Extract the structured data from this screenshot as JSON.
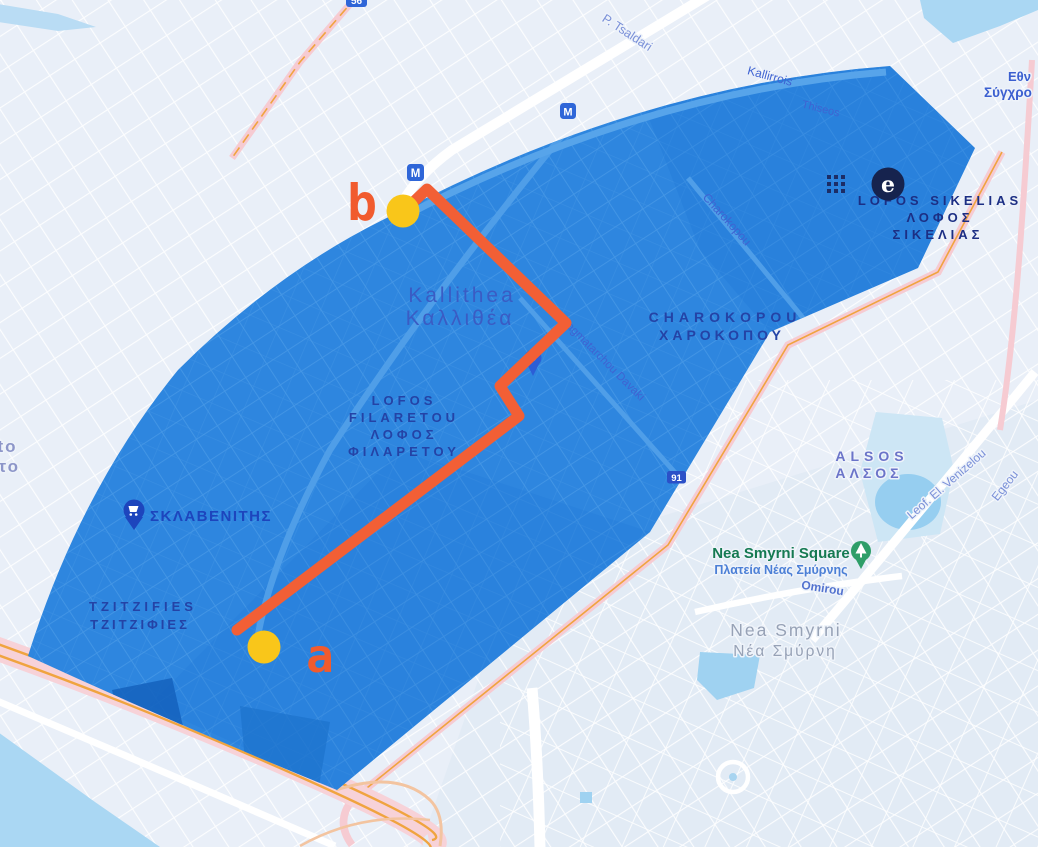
{
  "map": {
    "zone": {
      "description": "blue coverage zone over Kallithea",
      "fill_color": "#2e86df"
    },
    "route": {
      "color": "#f25f35",
      "marker_color": "#f9c61a",
      "marker_letter_color": "#f15b2e",
      "start_label": "a",
      "end_label": "b"
    },
    "region_labels": {
      "kallithea_en": "Kallithea",
      "kallithea_gr": "Καλλιθέα",
      "lofos_filaretou_l1": "LOFOS",
      "lofos_filaretou_l2": "FILARETOU",
      "lofos_filaretou_l3": "ΛΟΦΟΣ",
      "lofos_filaretou_l4": "ΦΙΛΑΡΕΤΟΥ",
      "charokopou_en": "CHAROKOPOU",
      "charokopou_gr": "ΧΑΡΟΚΟΠΟΥ",
      "lofos_sikelias_l1": "LOFOS SIKELIAS",
      "lofos_sikelias_l2": "ΛΟΦΟΣ",
      "lofos_sikelias_l3": "ΣΙΚΕΛΙΑΣ",
      "tzitzifies_en": "TZITZIFIES",
      "tzitzifies_gr": "ΤΖΙΤΖΙΦΙΕΣ",
      "alsos_en": "ALSOS",
      "alsos_gr": "ΑΛΣΟΣ",
      "nea_smyrni_en": "Nea Smyrni",
      "nea_smyrni_gr": "Νέα Σμύρνη",
      "moschato_partial_en": "ato",
      "moschato_partial_gr": "ατο",
      "museum_partial_l1": "Εθν",
      "museum_partial_l2": "Σύγχρο"
    },
    "street_labels": {
      "p_tsaldari": "P. Tsaldari",
      "kallirrois": "Kallirrois",
      "thiseos": "Thiseos",
      "charokopou_st": "Charokopou",
      "tagmatarchou_davaki": "agmatarchou Davaki",
      "omirou": "Omirou",
      "leof_el_venizelou": "Leof. El. Venizelou",
      "egeou": "Egeou"
    },
    "poi": {
      "sklavenitis": "ΣΚΛΑΒΕΝΙΤΗΣ",
      "nea_smyrni_square_en": "Nea Smyrni Square",
      "nea_smyrni_square_gr": "Πλατεία Νέας Σμύρνης"
    },
    "badges": {
      "metro": "M",
      "entrance": "e",
      "road_91": "91",
      "road_56": "56"
    },
    "colors": {
      "base_bg": "#e9eff8",
      "water": "#aad7f3",
      "road_pink": "#f6cbd2",
      "road_orange": "#f0a43f",
      "metro_badge_blue": "#2f66d8",
      "entrance_circle_navy": "#16234e",
      "district_label_blue": "#2443a6",
      "poi_green": "#157a52"
    }
  }
}
